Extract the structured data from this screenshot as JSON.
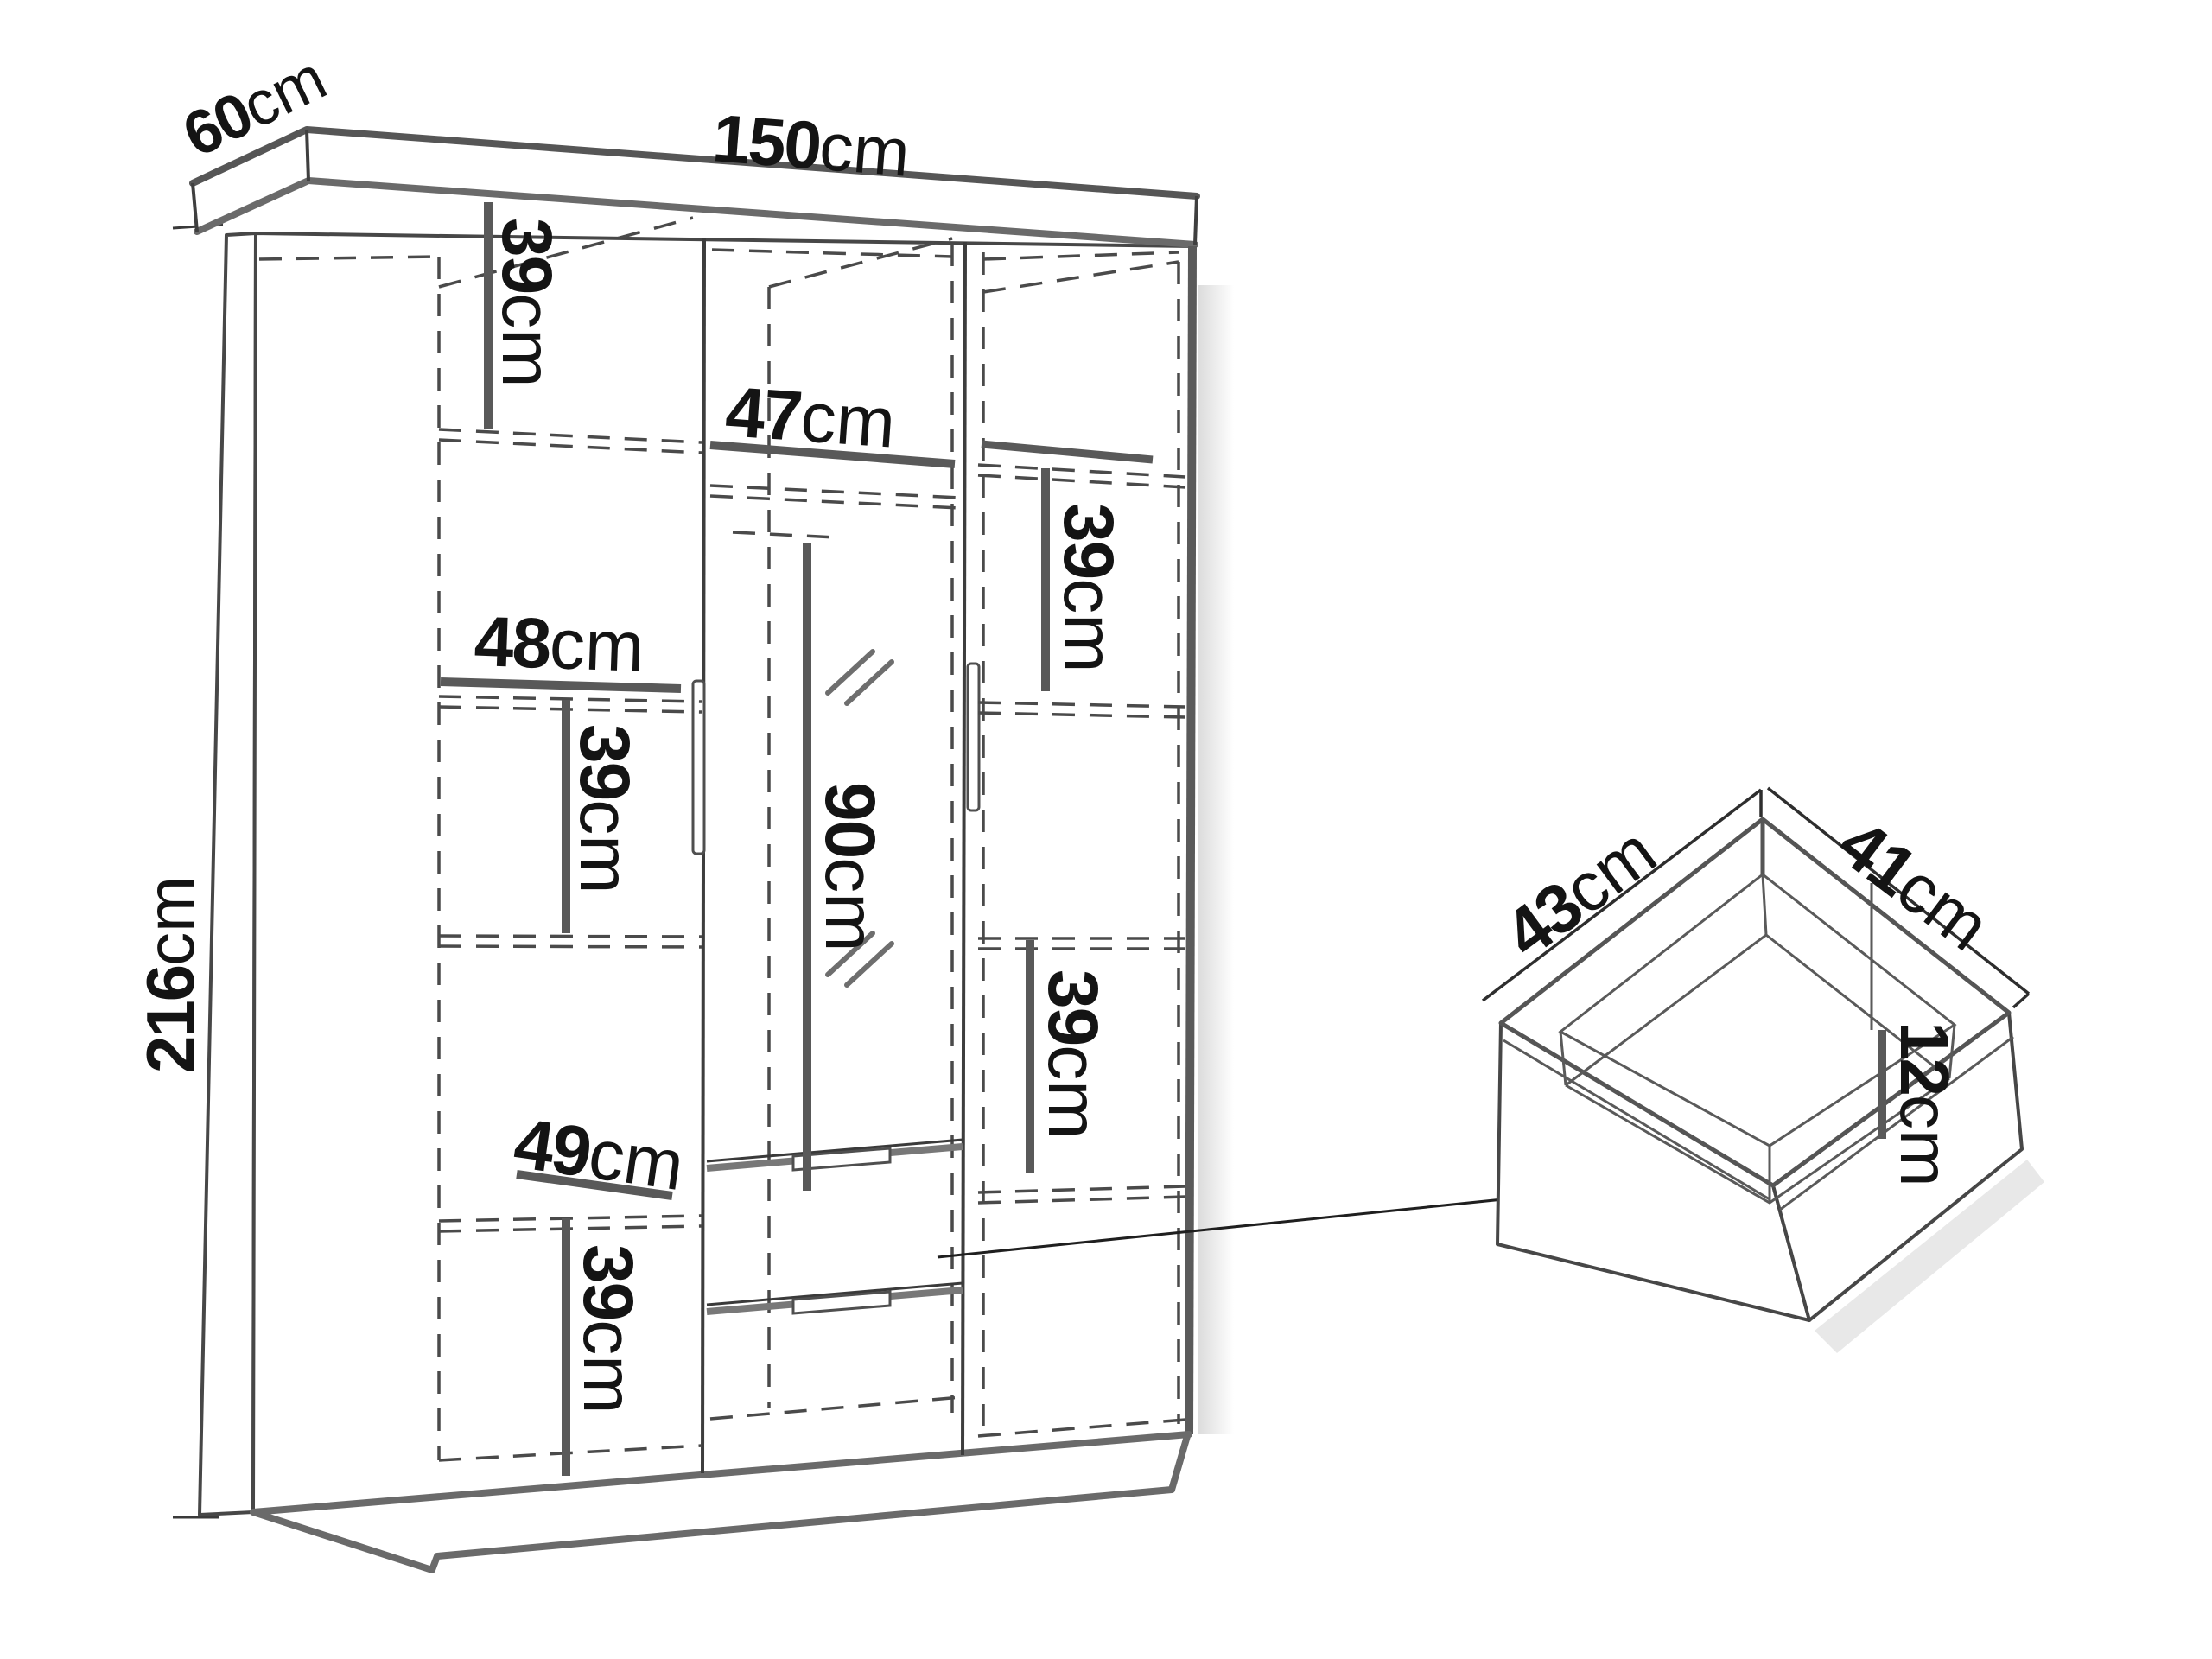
{
  "diagram_type": "furniture-dimension-drawing",
  "colors": {
    "background": "#ffffff",
    "line_dark": "#3f3f3f",
    "line_mid": "#5a5a5a",
    "dashed_line": "#4a4a4a",
    "text": "#141414"
  },
  "wardrobe": {
    "width": {
      "num": "150",
      "unit": "cm"
    },
    "depth": {
      "num": "60",
      "unit": "cm"
    },
    "height": {
      "num": "216",
      "unit": "cm"
    },
    "interior": {
      "left_top_shelf_height": {
        "num": "39",
        "unit": "cm"
      },
      "left_upper_width": {
        "num": "48",
        "unit": "cm"
      },
      "left_middle_shelf_height": {
        "num": "39",
        "unit": "cm"
      },
      "left_lower_width": {
        "num": "49",
        "unit": "cm"
      },
      "left_bottom_shelf_height": {
        "num": "39",
        "unit": "cm"
      },
      "middle_width": {
        "num": "47",
        "unit": "cm"
      },
      "middle_hanging_height": {
        "num": "90",
        "unit": "cm"
      },
      "right_upper_shelf_height": {
        "num": "39",
        "unit": "cm"
      },
      "right_lower_shelf_height": {
        "num": "39",
        "unit": "cm"
      }
    }
  },
  "drawer": {
    "width": {
      "num": "43",
      "unit": "cm"
    },
    "depth": {
      "num": "41",
      "unit": "cm"
    },
    "height": {
      "num": "12",
      "unit": "cm"
    }
  }
}
